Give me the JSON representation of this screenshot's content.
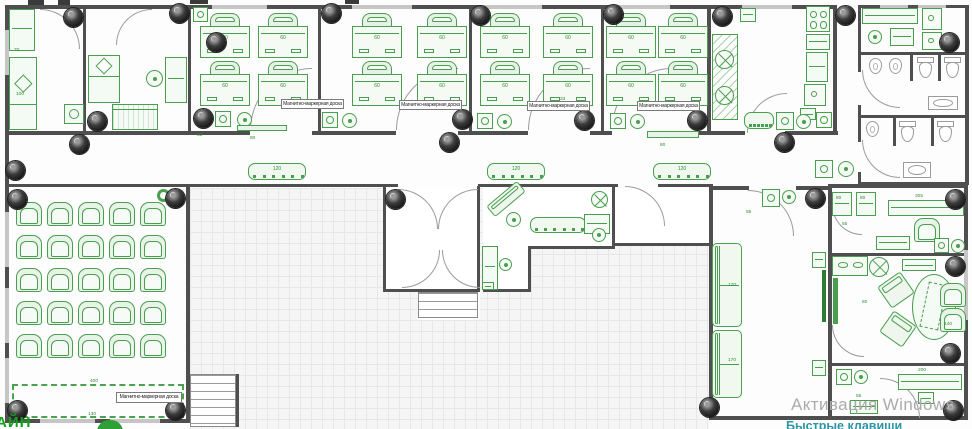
{
  "meta": {
    "width": 972,
    "height": 429,
    "type": "architectural floor plan"
  },
  "colors": {
    "furniture": "#4a9e4f",
    "wall": "#4f4f4f",
    "camera": "#1a1a1a",
    "watermark_gray": "#ababab",
    "watermark_teal": "#2e95a3",
    "logo_green": "#12a01c"
  },
  "watermark": {
    "line1": "Активация Windows",
    "line2": "Быстрые клавиши"
  },
  "logo": {
    "text": "АЙН"
  },
  "board_label": "Магнитно-маркерная доска",
  "desk_dim": "60",
  "plan": {
    "grids": [
      [
        190,
        188,
        519,
        241
      ]
    ],
    "whites": [
      [
        386,
        188,
        91,
        102
      ],
      [
        483,
        188,
        129,
        58
      ],
      [
        483,
        246,
        45,
        44
      ],
      [
        615,
        188,
        94,
        55
      ],
      [
        418,
        292,
        62,
        28
      ]
    ],
    "walls": [
      [
        5,
        5,
        830,
        4
      ],
      [
        858,
        5,
        110,
        3
      ],
      [
        5,
        5,
        4,
        418
      ],
      [
        5,
        419,
        185,
        4
      ],
      [
        186,
        184,
        4,
        239
      ],
      [
        5,
        131,
        245,
        4
      ],
      [
        312,
        131,
        84,
        4
      ],
      [
        458,
        131,
        70,
        4
      ],
      [
        590,
        131,
        22,
        4
      ],
      [
        672,
        131,
        73,
        4
      ],
      [
        785,
        131,
        53,
        4
      ],
      [
        5,
        184,
        393,
        3
      ],
      [
        478,
        184,
        140,
        3
      ],
      [
        658,
        184,
        55,
        3
      ],
      [
        83,
        5,
        3,
        128
      ],
      [
        188,
        5,
        3,
        128
      ],
      [
        318,
        5,
        3,
        128
      ],
      [
        469,
        5,
        3,
        128
      ],
      [
        601,
        5,
        3,
        128
      ],
      [
        707,
        5,
        4,
        130
      ],
      [
        833,
        5,
        4,
        130
      ],
      [
        858,
        5,
        3,
        67
      ],
      [
        858,
        105,
        3,
        37
      ],
      [
        858,
        172,
        3,
        13
      ],
      [
        965,
        5,
        4,
        180
      ],
      [
        858,
        52,
        107,
        3
      ],
      [
        858,
        115,
        107,
        3
      ],
      [
        858,
        182,
        107,
        3
      ],
      [
        709,
        186,
        40,
        4
      ],
      [
        796,
        186,
        36,
        4
      ],
      [
        828,
        184,
        140,
        4
      ],
      [
        709,
        188,
        4,
        232
      ],
      [
        828,
        188,
        4,
        232
      ],
      [
        964,
        188,
        4,
        232
      ],
      [
        709,
        416,
        259,
        4
      ],
      [
        832,
        253,
        132,
        3
      ],
      [
        832,
        363,
        132,
        3
      ],
      [
        383,
        186,
        3,
        105
      ],
      [
        477,
        186,
        3,
        105
      ],
      [
        383,
        289,
        97,
        3
      ],
      [
        612,
        186,
        3,
        63
      ],
      [
        528,
        246,
        87,
        3
      ],
      [
        528,
        246,
        3,
        46
      ],
      [
        483,
        289,
        48,
        3
      ],
      [
        612,
        243,
        97,
        3
      ],
      [
        236,
        374,
        3,
        53
      ],
      [
        893,
        118,
        3,
        28
      ],
      [
        931,
        118,
        3,
        28
      ],
      [
        938,
        55,
        3,
        26
      ],
      [
        910,
        55,
        3,
        26
      ]
    ],
    "wins": [
      [
        5,
        30,
        4,
        45
      ],
      [
        5,
        212,
        4,
        55
      ],
      [
        5,
        288,
        4,
        55
      ],
      [
        5,
        358,
        4,
        45
      ],
      [
        212,
        5,
        55,
        4
      ],
      [
        352,
        5,
        60,
        4
      ],
      [
        482,
        5,
        60,
        4
      ],
      [
        612,
        5,
        58,
        4
      ],
      [
        742,
        5,
        50,
        4
      ],
      [
        880,
        5,
        28,
        3
      ],
      [
        918,
        5,
        28,
        3
      ],
      [
        964,
        250,
        4,
        70
      ],
      [
        40,
        419,
        55,
        4
      ],
      [
        110,
        419,
        50,
        4
      ]
    ],
    "marks": [
      [
        28,
        0,
        16,
        5
      ],
      [
        58,
        0,
        12,
        5
      ],
      [
        190,
        0,
        18,
        4
      ],
      [
        345,
        0,
        14,
        4
      ]
    ],
    "arcs": [
      [
        250,
        68,
        62,
        "tl"
      ],
      [
        396,
        68,
        62,
        "tl"
      ],
      [
        528,
        68,
        62,
        "tl"
      ],
      [
        612,
        68,
        60,
        "tl"
      ],
      [
        40,
        9,
        40,
        "tr"
      ],
      [
        116,
        9,
        36,
        "tl"
      ],
      [
        747,
        93,
        40,
        "tl"
      ],
      [
        862,
        70,
        38,
        "bl"
      ],
      [
        862,
        140,
        38,
        "bl"
      ],
      [
        748,
        190,
        46,
        "tr"
      ],
      [
        625,
        186,
        40,
        "tr"
      ],
      [
        398,
        189,
        40,
        "tr"
      ],
      [
        438,
        189,
        40,
        "tl"
      ],
      [
        402,
        250,
        38,
        "br"
      ],
      [
        442,
        250,
        38,
        "bl"
      ],
      [
        832,
        205,
        30,
        "bl"
      ],
      [
        832,
        325,
        32,
        "bl"
      ],
      [
        880,
        378,
        40,
        "tr"
      ]
    ],
    "items": [
      [
        "desk",
        200,
        13
      ],
      [
        "desk",
        258,
        13
      ],
      [
        "desk",
        200,
        61
      ],
      [
        "desk",
        258,
        61
      ],
      [
        "desk",
        352,
        13
      ],
      [
        "desk",
        417,
        13
      ],
      [
        "desk",
        352,
        61
      ],
      [
        "desk",
        417,
        61
      ],
      [
        "desk",
        480,
        13
      ],
      [
        "desk",
        543,
        13
      ],
      [
        "desk",
        480,
        61
      ],
      [
        "desk",
        543,
        61
      ],
      [
        "desk",
        606,
        13
      ],
      [
        "desk",
        658,
        13
      ],
      [
        "desk",
        606,
        61
      ],
      [
        "desk",
        658,
        61
      ],
      [
        "sq",
        193,
        7,
        15
      ],
      [
        "sq",
        215,
        111,
        16
      ],
      [
        "circ",
        237,
        112,
        15
      ],
      [
        "sq",
        322,
        112,
        16
      ],
      [
        "circ",
        342,
        113,
        15
      ],
      [
        "sq",
        477,
        113,
        16
      ],
      [
        "circ",
        497,
        114,
        15
      ],
      [
        "sq",
        610,
        113,
        16
      ],
      [
        "circ",
        630,
        114,
        15
      ],
      [
        "bench",
        248,
        163,
        58,
        17,
        "120"
      ],
      [
        "bench",
        487,
        163,
        58,
        17,
        "120"
      ],
      [
        "bench",
        653,
        163,
        58,
        17,
        "120"
      ],
      [
        "gline",
        237,
        125,
        50,
        6
      ],
      [
        "gline",
        647,
        131,
        52,
        7
      ],
      [
        "sq",
        815,
        160,
        18
      ],
      [
        "circ",
        838,
        161,
        16
      ],
      [
        "gr",
        9,
        9,
        26,
        42
      ],
      [
        "ward",
        9,
        57,
        28,
        73
      ],
      [
        "sq",
        64,
        104,
        20
      ],
      [
        "bed",
        88,
        55,
        32,
        48
      ],
      [
        "gr",
        165,
        57,
        22,
        46
      ],
      [
        "circ",
        146,
        70,
        17
      ],
      [
        "piano",
        112,
        104,
        46,
        26
      ],
      [
        "rack",
        712,
        34,
        26,
        86
      ],
      [
        "fan",
        715,
        50,
        19
      ],
      [
        "fan",
        715,
        86,
        19
      ],
      [
        "gr",
        740,
        8,
        16,
        14
      ],
      [
        "stove",
        806,
        6,
        24,
        26,
        4
      ],
      [
        "gr",
        806,
        34,
        24,
        16
      ],
      [
        "gr",
        806,
        52,
        22,
        30
      ],
      [
        "stove",
        804,
        84,
        22,
        22,
        1
      ],
      [
        "gr",
        800,
        108,
        16,
        12
      ],
      [
        "bench",
        744,
        112,
        30,
        17,
        ""
      ],
      [
        "sq",
        776,
        112,
        18
      ],
      [
        "circ",
        796,
        114,
        15
      ],
      [
        "sq",
        816,
        112,
        16
      ],
      [
        "gr",
        862,
        8,
        56,
        16
      ],
      [
        "stove",
        922,
        8,
        20,
        22,
        1
      ],
      [
        "stove",
        922,
        32,
        20,
        18,
        1
      ],
      [
        "gr",
        890,
        28,
        24,
        18
      ],
      [
        "circ",
        868,
        30,
        14
      ],
      [
        "ur",
        869,
        58,
        13,
        16
      ],
      [
        "ur",
        889,
        58,
        13,
        16
      ],
      [
        "wc",
        917,
        57
      ],
      [
        "wc",
        944,
        57
      ],
      [
        "sinkg",
        928,
        96,
        30,
        14
      ],
      [
        "ur",
        866,
        121,
        13,
        16
      ],
      [
        "wc",
        899,
        121
      ],
      [
        "wc",
        937,
        121
      ],
      [
        "sinkg",
        903,
        162,
        28,
        16
      ],
      [
        "lchair",
        16,
        202
      ],
      [
        "lchair",
        47,
        202
      ],
      [
        "lchair",
        78,
        202
      ],
      [
        "lchair",
        109,
        202
      ],
      [
        "lchair",
        140,
        202
      ],
      [
        "lchair",
        16,
        235
      ],
      [
        "lchair",
        47,
        235
      ],
      [
        "lchair",
        78,
        235
      ],
      [
        "lchair",
        109,
        235
      ],
      [
        "lchair",
        140,
        235
      ],
      [
        "lchair",
        16,
        268
      ],
      [
        "lchair",
        47,
        268
      ],
      [
        "lchair",
        78,
        268
      ],
      [
        "lchair",
        109,
        268
      ],
      [
        "lchair",
        140,
        268
      ],
      [
        "lchair",
        16,
        301
      ],
      [
        "lchair",
        47,
        301
      ],
      [
        "lchair",
        78,
        301
      ],
      [
        "lchair",
        109,
        301
      ],
      [
        "lchair",
        140,
        301
      ],
      [
        "lchair",
        16,
        334
      ],
      [
        "lchair",
        47,
        334
      ],
      [
        "lchair",
        78,
        334
      ],
      [
        "lchair",
        109,
        334
      ],
      [
        "lchair",
        140,
        334
      ],
      [
        "board",
        12,
        384,
        172,
        34
      ],
      [
        "donut",
        157,
        189,
        13
      ],
      [
        "stairs",
        190,
        374,
        46,
        53
      ],
      [
        "stairs",
        418,
        292,
        60,
        26
      ],
      [
        "diag",
        486,
        192,
        40,
        14,
        -40
      ],
      [
        "circ",
        506,
        212,
        15
      ],
      [
        "bench",
        530,
        217,
        56,
        16,
        ""
      ],
      [
        "fan",
        591,
        191,
        17
      ],
      [
        "gr",
        584,
        214,
        26,
        20
      ],
      [
        "circ",
        592,
        228,
        14
      ],
      [
        "gr",
        482,
        246,
        16,
        44
      ],
      [
        "circ",
        499,
        258,
        13
      ],
      [
        "gr",
        482,
        282,
        12,
        8
      ],
      [
        "sofa",
        712,
        243,
        30,
        84
      ],
      [
        "sofa",
        712,
        330,
        30,
        68
      ],
      [
        "sq",
        762,
        189,
        18
      ],
      [
        "circ",
        782,
        190,
        14
      ],
      [
        "tv",
        822,
        270,
        4,
        52
      ],
      [
        "gr",
        812,
        252,
        14,
        16
      ],
      [
        "gr",
        812,
        360,
        14,
        16
      ],
      [
        "gr",
        832,
        192,
        20,
        24
      ],
      [
        "gr",
        856,
        192,
        20,
        24
      ],
      [
        "gr",
        888,
        200,
        76,
        16
      ],
      [
        "lchair",
        914,
        218
      ],
      [
        "gr",
        876,
        236,
        34,
        14
      ],
      [
        "sq",
        934,
        238,
        15
      ],
      [
        "circ",
        951,
        239,
        14
      ],
      [
        "stove",
        832,
        256,
        36,
        20,
        2
      ],
      [
        "fan",
        869,
        257,
        20
      ],
      [
        "gr",
        902,
        259,
        34,
        12
      ],
      [
        "gfillrect",
        833,
        278,
        5,
        46
      ],
      [
        "oval",
        912,
        274,
        44,
        66
      ],
      [
        "diag",
        882,
        277,
        28,
        26,
        -35
      ],
      [
        "diag",
        884,
        316,
        28,
        26,
        35
      ],
      [
        "lchair",
        940,
        283
      ],
      [
        "lchair",
        940,
        308
      ],
      [
        "sq",
        836,
        369,
        16
      ],
      [
        "circ",
        854,
        370,
        14
      ],
      [
        "gr",
        898,
        374,
        64,
        16
      ],
      [
        "gr",
        918,
        392,
        16,
        12
      ],
      [
        "gr",
        850,
        400,
        28,
        14
      ]
    ],
    "cams": [
      [
        64,
        8
      ],
      [
        170,
        4
      ],
      [
        207,
        33
      ],
      [
        88,
        112
      ],
      [
        194,
        109
      ],
      [
        322,
        4
      ],
      [
        453,
        110
      ],
      [
        471,
        6
      ],
      [
        575,
        111
      ],
      [
        604,
        5
      ],
      [
        688,
        111
      ],
      [
        713,
        7
      ],
      [
        836,
        6
      ],
      [
        940,
        33
      ],
      [
        775,
        133
      ],
      [
        440,
        133
      ],
      [
        70,
        135
      ],
      [
        6,
        161
      ],
      [
        8,
        190
      ],
      [
        166,
        189
      ],
      [
        8,
        401
      ],
      [
        166,
        401
      ],
      [
        386,
        190
      ],
      [
        806,
        189
      ],
      [
        700,
        398
      ],
      [
        946,
        190
      ],
      [
        946,
        257
      ],
      [
        941,
        344
      ],
      [
        944,
        401
      ]
    ],
    "labels": [
      [
        281,
        99,
        63,
        10
      ],
      [
        399,
        100,
        63,
        10
      ],
      [
        527,
        101,
        63,
        10
      ],
      [
        637,
        101,
        63,
        10
      ],
      [
        116,
        392,
        66,
        11
      ]
    ],
    "dims": [
      [
        "70",
        14,
        48
      ],
      [
        "100",
        16,
        92
      ],
      [
        "33",
        197,
        133
      ],
      [
        "33",
        560,
        97
      ],
      [
        "80",
        250,
        136
      ],
      [
        "80",
        660,
        143
      ],
      [
        "400",
        90,
        379
      ],
      [
        "130",
        88,
        412
      ],
      [
        "85",
        746,
        210
      ],
      [
        "170",
        728,
        283
      ],
      [
        "170",
        728,
        358
      ],
      [
        "80",
        836,
        196
      ],
      [
        "80",
        860,
        196
      ],
      [
        "305",
        915,
        194
      ],
      [
        "55",
        842,
        222
      ],
      [
        "80",
        862,
        300
      ],
      [
        "140",
        944,
        322
      ],
      [
        "200",
        918,
        368
      ],
      [
        "55",
        856,
        394
      ]
    ]
  }
}
